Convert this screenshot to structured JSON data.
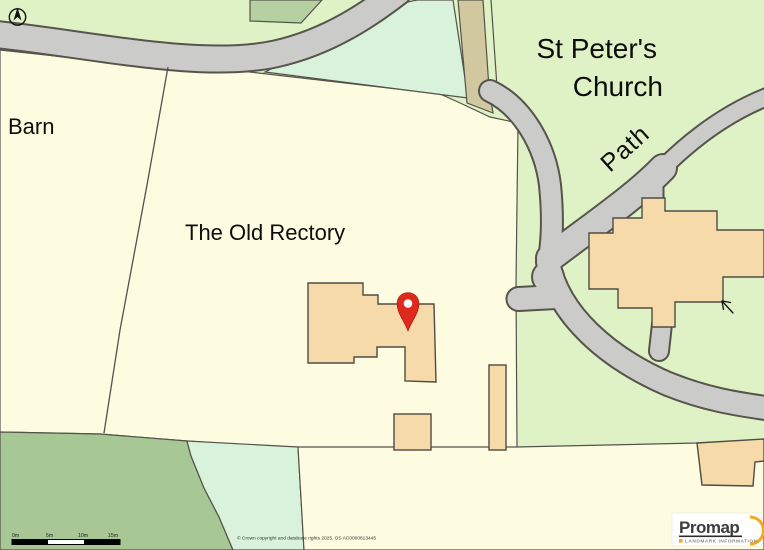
{
  "map": {
    "labels": {
      "barn": "Barn",
      "old_rectory": "The Old Rectory",
      "church_line1": "St Peter's",
      "church_line2": "Church",
      "path": "Path"
    },
    "scale_bar": {
      "ticks": [
        "0m",
        "5m",
        "10m",
        "15m"
      ]
    },
    "copyright": "© Crown copyright and database rights 2025. OS AC0000813445",
    "logo": {
      "brand": "Promap",
      "tagline": "LANDMARK INFORMATION"
    },
    "marker": {
      "type": "location-pin",
      "color": "#df291d"
    },
    "colors": {
      "field_cream": "#fdfce0",
      "grass_green": "#dff2c6",
      "mint_green": "#d9f2db",
      "sage_green": "#a7c795",
      "dark_green": "#b6d1a1",
      "road_gray": "#cbcbc9",
      "path_tan": "#d2c8a0",
      "building_orange": "#f7daa9",
      "outline": "#54524a",
      "pin_red": "#e02b20",
      "logo_orange": "#f6a81c"
    }
  }
}
